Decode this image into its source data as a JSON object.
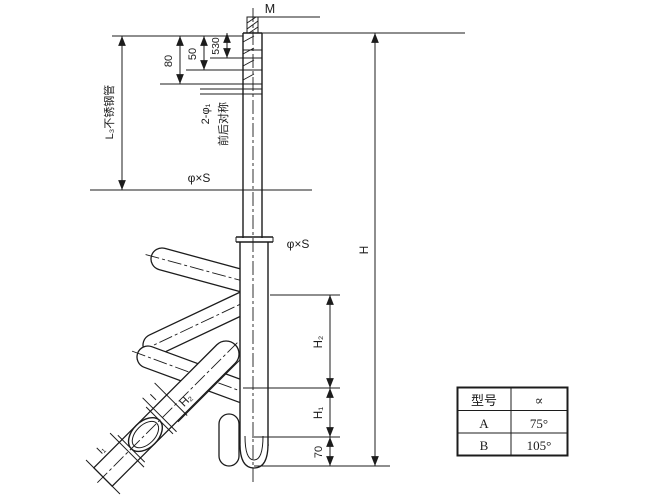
{
  "drawing": {
    "labels": {
      "thread": "M",
      "dim_530": "530",
      "dim_50": "50",
      "dim_80": "80",
      "left_tube_note": "L₃不锈钢管",
      "holes": "2-φ₁",
      "symmetry_note": "前后对称",
      "tube_spec_upper": "φ×S",
      "tube_spec_lower": "φ×S",
      "height_total": "H",
      "dim_h2_right": "H₂",
      "dim_h1": "H₁",
      "dim_70": "70",
      "dim_h2_angled": "H₂",
      "dim_l": "l",
      "dim_l1": "l₁"
    },
    "colors": {
      "line": "#1c1c1c",
      "background": "#ffffff"
    }
  },
  "table": {
    "headers": [
      "型号",
      "∝"
    ],
    "rows": [
      {
        "model": "A",
        "angle": "75°"
      },
      {
        "model": "B",
        "angle": "105°"
      }
    ]
  }
}
